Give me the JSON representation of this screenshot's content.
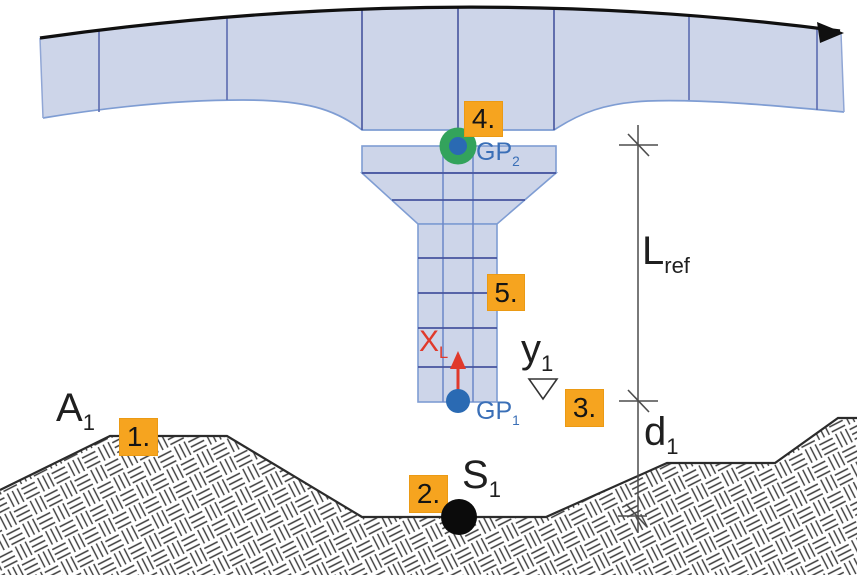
{
  "figure": {
    "name": "bridge-pier-reference-length-diagram",
    "markers": [
      {
        "id": "1",
        "label": "1."
      },
      {
        "id": "2",
        "label": "2."
      },
      {
        "id": "3",
        "label": "3."
      },
      {
        "id": "4",
        "label": "4."
      },
      {
        "id": "5",
        "label": "5."
      }
    ],
    "labels": {
      "A1": {
        "main": "A",
        "sub": "1"
      },
      "S1": {
        "main": "S",
        "sub": "1"
      },
      "y1": {
        "main": "y",
        "sub": "1"
      },
      "d1": {
        "main": "d",
        "sub": "1"
      },
      "Lref": {
        "main": "L",
        "sub": "ref"
      },
      "GP1": {
        "main": "GP",
        "sub": "1"
      },
      "GP2": {
        "main": "GP",
        "sub": "2"
      },
      "XL": {
        "main": "X",
        "sub": "L"
      }
    },
    "symbols": {
      "flow_arrow": "black arrow along deck axis",
      "water_level": "open triangle level symbol",
      "xl_axis": "red local axis arrow at pier base"
    },
    "colors": {
      "deck_fill": "#cdd5e9",
      "deck_outline": "#7f9dd3",
      "deck_divider": "#5b6cb0",
      "segment_line_dark": "#46549e",
      "axis_black": "#101010",
      "terrain_outline": "#2b2b2b",
      "hatch_line": "#3a3a3a",
      "marker_bg": "#f6a41f",
      "red_axis": "#e0392b",
      "point_blue": "#2a6ab3",
      "point_green": "#33a35c",
      "point_black": "#0b0b0b",
      "label_blue": "#3a6fb7",
      "dim_line": "#4d4d4d"
    }
  }
}
